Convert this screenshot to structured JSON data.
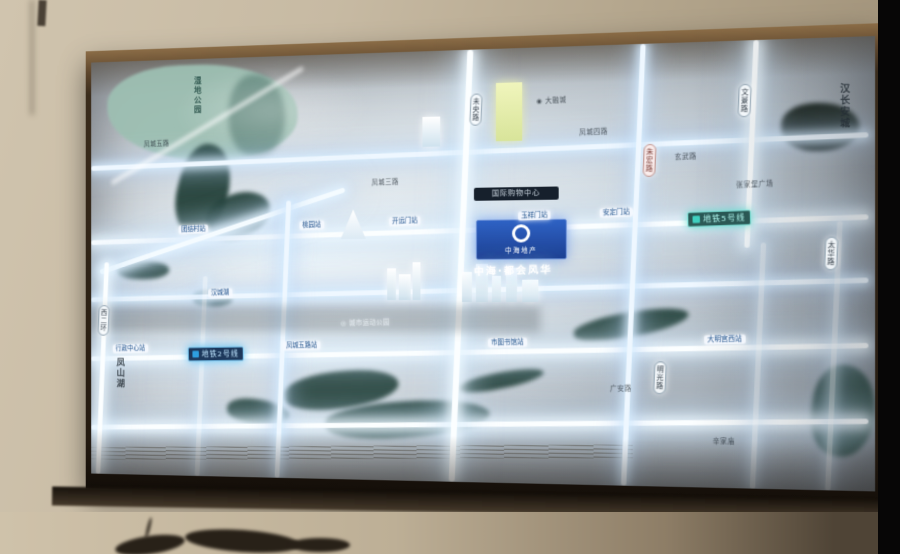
{
  "map": {
    "metro_line5_badge": {
      "text": "地铁5号线"
    },
    "metro_line2_badge": {
      "text": "地铁2号线"
    },
    "project": {
      "plaque": "中海地产",
      "name_glow": "中海·都会风华",
      "mall": "国际购物中心"
    },
    "labels": [
      {
        "id": "lake-name",
        "kind": "vtext lakezi",
        "text": "湿地公园",
        "x": 112,
        "y": 18
      },
      {
        "id": "district-name",
        "kind": "vtext",
        "text": "凤山湖",
        "x": 26,
        "y": 310
      },
      {
        "id": "heritage-name",
        "kind": "vtext",
        "text": "汉长安城",
        "x": 752,
        "y": 44
      },
      {
        "id": "road-plate-weiyang",
        "kind": "roadplate",
        "text": "未央路",
        "x": 400,
        "y": 44
      },
      {
        "id": "road-plate-wenjing",
        "kind": "roadplate",
        "text": "文景路",
        "x": 660,
        "y": 42
      },
      {
        "id": "road-plate-zhuhong",
        "kind": "roadplate red",
        "text": "朱宏路",
        "x": 570,
        "y": 98
      },
      {
        "id": "road-plate-taihua",
        "kind": "roadplate",
        "text": "太华路",
        "x": 740,
        "y": 190
      },
      {
        "id": "road-plate-mingguang",
        "kind": "roadplate",
        "text": "明光路",
        "x": 580,
        "y": 310
      },
      {
        "id": "road-plate-xierhuan",
        "kind": "roadplate",
        "text": "西二环",
        "x": 8,
        "y": 255
      },
      {
        "id": "station-tuanjie",
        "kind": "station",
        "text": "团结村站",
        "x": 96,
        "y": 172
      },
      {
        "id": "station-taoyuan",
        "kind": "station",
        "text": "桃园站",
        "x": 225,
        "y": 169
      },
      {
        "id": "station-kaiyuanmen",
        "kind": "station",
        "text": "开远门站",
        "x": 318,
        "y": 166
      },
      {
        "id": "station-yuxiangmen",
        "kind": "station",
        "text": "玉祥门站",
        "x": 448,
        "y": 162
      },
      {
        "id": "station-andingmen",
        "kind": "station",
        "text": "安定门站",
        "x": 528,
        "y": 160
      },
      {
        "id": "station-xingzheng",
        "kind": "station",
        "text": "行政中心站",
        "x": 24,
        "y": 296
      },
      {
        "id": "station-fengwu",
        "kind": "station",
        "text": "凤城五路站",
        "x": 208,
        "y": 292
      },
      {
        "id": "station-tushuguan",
        "kind": "station",
        "text": "市图书馆站",
        "x": 418,
        "y": 288
      },
      {
        "id": "station-damingong",
        "kind": "station",
        "text": "大明宫西站",
        "x": 628,
        "y": 284
      },
      {
        "id": "plate-hanchenghu",
        "kind": "station",
        "text": "汉城湖",
        "x": 128,
        "y": 238
      },
      {
        "id": "road-fengcheng5",
        "kind": "htext",
        "text": "凤城五路",
        "x": 58,
        "y": 84
      },
      {
        "id": "road-fengcheng4",
        "kind": "htext",
        "text": "凤城四路",
        "x": 508,
        "y": 82
      },
      {
        "id": "road-fengcheng3",
        "kind": "htext",
        "text": "凤城三路",
        "x": 300,
        "y": 128
      },
      {
        "id": "road-xuanwu",
        "kind": "htext",
        "text": "玄武路",
        "x": 600,
        "y": 108
      },
      {
        "id": "plaza-zhangjiabao",
        "kind": "htext",
        "text": "张家堡广场",
        "x": 658,
        "y": 136
      },
      {
        "id": "park-sports",
        "kind": "htext light",
        "text": "◎ 城市运动公园",
        "x": 268,
        "y": 270
      },
      {
        "id": "mall-darongcheng",
        "kind": "htext",
        "text": "◉ 大融城",
        "x": 466,
        "y": 50
      },
      {
        "id": "area-guangan",
        "kind": "htext",
        "text": "广安路",
        "x": 538,
        "y": 334
      },
      {
        "id": "area-xinjiamiao",
        "kind": "htext",
        "text": "辛家庙",
        "x": 636,
        "y": 384
      }
    ]
  }
}
